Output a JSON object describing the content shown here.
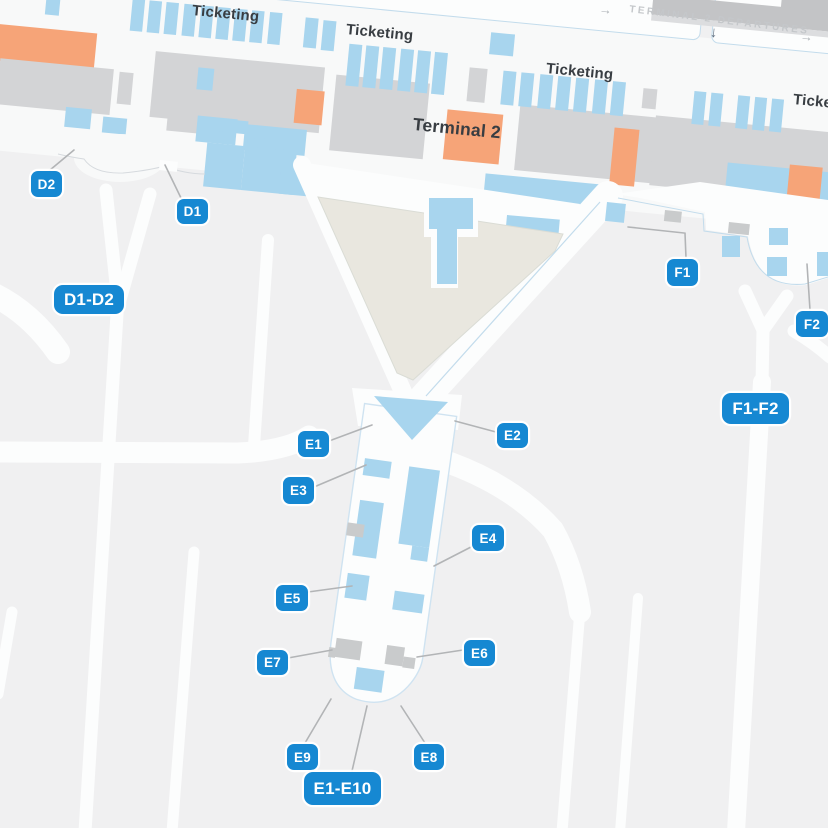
{
  "colors": {
    "bg": "#f0f0f1",
    "terminal-strip": "#f8f9f9",
    "road-white": "#fcfdfd",
    "building-gray": "#d3d4d6",
    "road-gray": "#c3c4c6",
    "road-gray-light": "#dcdddf",
    "light-blue": "#a8d5ee",
    "orange": "#f6a478",
    "secure-beige": "#e9e7df",
    "badge-blue": "#1688d2",
    "hairline-blue": "#c3dcec",
    "leader-gray": "#b2b4b6",
    "label-dark": "#383d42",
    "sign-text": "#c4c7ca",
    "arrow-dark": "#5d6c7e",
    "arrow-light": "#a9aeb3",
    "jet-gray": "#c9cbcc"
  },
  "labels": {
    "ticketing": "Ticketing",
    "terminal": "Terminal 2",
    "departures_sign": "TERMINAL 2 DEPARTURES"
  },
  "icons": {
    "down_arrow": "↓",
    "right_arrow": "→"
  },
  "badges": {
    "d1": "D1",
    "d2": "D2",
    "d1d2": "D1-D2",
    "e1": "E1",
    "e2": "E2",
    "e3": "E3",
    "e4": "E4",
    "e5": "E5",
    "e6": "E6",
    "e7": "E7",
    "e8": "E8",
    "e9": "E9",
    "e1e10": "E1-E10",
    "f1": "F1",
    "f2": "F2",
    "f1f2": "F1-F2"
  }
}
